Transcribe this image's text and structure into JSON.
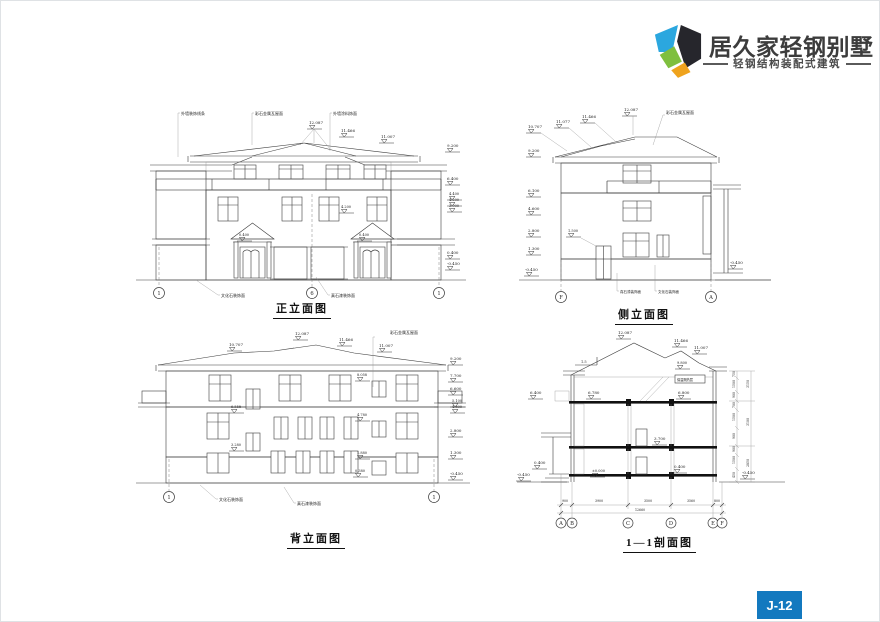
{
  "header": {
    "brand": "居久家轻钢别墅",
    "tagline": "轻钢结构装配式建筑"
  },
  "page": {
    "badge": "J-12"
  },
  "front": {
    "title": "正立面图",
    "n1": "外墙装饰线条",
    "n2": "彩石金属瓦屋面",
    "n3": "外墙涂料饰面",
    "b1": "文化石装饰面",
    "b2": "真石漆装饰面",
    "t1": "12.087",
    "t2": "11.466",
    "t3": "11.007",
    "r1": "9.200",
    "r2": "6.400",
    "r3": "4.400",
    "r4": "4.200",
    "r5": "3.900",
    "r6": "0.400",
    "r7": "-0.450",
    "m1": "4.200",
    "m2": "0.400",
    "m3": "0.400",
    "g1": "1",
    "g2": "6",
    "g3": "1"
  },
  "side": {
    "title": "侧立面图",
    "n1": "彩石金属瓦屋面",
    "b1": "真石漆装饰面",
    "b2": "文化石装饰面",
    "t1": "10.707",
    "t2": "11.077",
    "t3": "11.466",
    "t4": "12.087",
    "l1": "9.200",
    "l2": "6.100",
    "l3": "4.600",
    "l4": "2.800",
    "l5": "1.300",
    "l6": "-0.450",
    "m1": "1.500",
    "r1": "-0.450",
    "g1": "F",
    "g2": "A"
  },
  "rear": {
    "title": "背立面图",
    "n1": "彩石金属瓦屋面",
    "b1": "文化石装饰面",
    "b2": "真石漆装饰面",
    "t1": "10.707",
    "t2": "12.087",
    "t3": "11.466",
    "t4": "11.007",
    "r1": "9.200",
    "r2": "7.700",
    "r3": "6.600",
    "r4": "5.100",
    "r5": "4.800",
    "r6": "2.800",
    "r7": "1.300",
    "r8": "-0.450",
    "m1": "8.058",
    "m2": "6.558",
    "m3": "4.780",
    "m4": "3.280",
    "m5": "1.880",
    "m6": "0.380",
    "g1": "1",
    "g2": "1"
  },
  "section": {
    "title": "1—1剖面图",
    "slope": "1.5",
    "note": "保温隔热层",
    "t1": "12.087",
    "t2": "11.466",
    "t3": "11.007",
    "t4": "9.800",
    "l1": "6.400",
    "l2": "0.400",
    "l3": "-0.450",
    "m1": "6.780",
    "m2": "6.800",
    "m3": "3.700",
    "m4": "0.400",
    "m5": "±0.000",
    "r1": "-0.450",
    "d1": "900",
    "d2": "3900",
    "d3": "3500",
    "d4": "3560",
    "d5": "800",
    "dt": "12660",
    "v1": "750",
    "v2": "1500",
    "v3": "900",
    "v4": "700",
    "v5": "1500",
    "v6": "900",
    "v7": "900",
    "v8": "1500",
    "v9": "450",
    "o1": "3150",
    "o2": "3100",
    "o3": "2850",
    "g1": "A",
    "g2": "B",
    "g3": "C",
    "g4": "D",
    "g5": "E",
    "g6": "F"
  }
}
